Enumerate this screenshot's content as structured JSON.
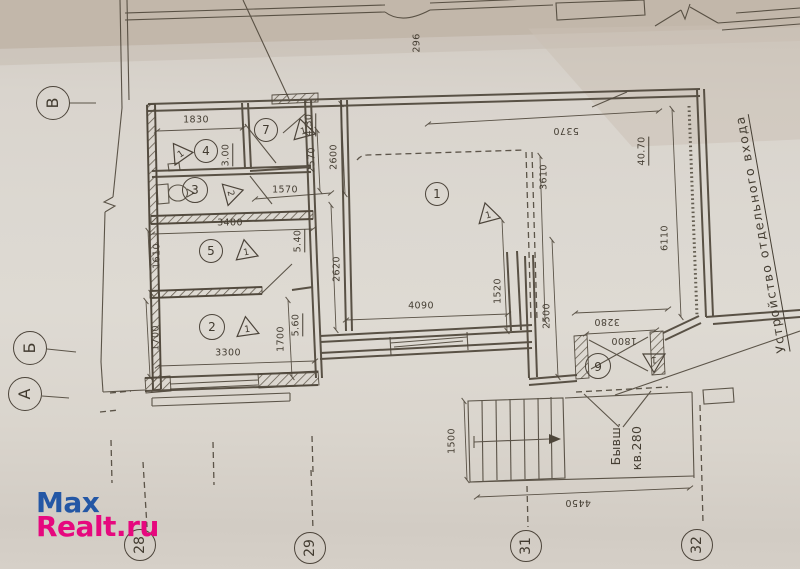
{
  "document_type": "floor-plan-photo",
  "ink_color": "#4e463a",
  "watermark": {
    "line1": "Max",
    "line2": "Realt.ru",
    "color1": "#2457a5",
    "color2": "#e6087e"
  },
  "axis_circles": [
    {
      "label": "В",
      "x": 53,
      "y": 103,
      "r": 17,
      "rot": -90
    },
    {
      "label": "Б",
      "x": 30,
      "y": 348,
      "r": 17,
      "rot": -90
    },
    {
      "label": "А",
      "x": 25,
      "y": 394,
      "r": 17,
      "rot": -90
    },
    {
      "label": "28",
      "x": 140,
      "y": 545,
      "r": 16,
      "rot": -90
    },
    {
      "label": "29",
      "x": 310,
      "y": 548,
      "r": 16,
      "rot": -90
    },
    {
      "label": "31",
      "x": 526,
      "y": 546,
      "r": 16,
      "rot": -90
    },
    {
      "label": "32",
      "x": 697,
      "y": 545,
      "r": 16,
      "rot": -90
    }
  ],
  "room_circles": [
    {
      "label": "1",
      "x": 437,
      "y": 194,
      "r": 12,
      "rot": 0
    },
    {
      "label": "2",
      "x": 212,
      "y": 327,
      "r": 13,
      "rot": 0
    },
    {
      "label": "3",
      "x": 195,
      "y": 190,
      "r": 13,
      "rot": 0
    },
    {
      "label": "4",
      "x": 206,
      "y": 151,
      "r": 12,
      "rot": 0
    },
    {
      "label": "5",
      "x": 211,
      "y": 251,
      "r": 12,
      "rot": 0
    },
    {
      "label": "6",
      "x": 598,
      "y": 366,
      "r": 13,
      "rot": 180
    },
    {
      "label": "7",
      "x": 266,
      "y": 130,
      "r": 12,
      "rot": 0
    }
  ],
  "triangle_markers": [
    {
      "label": "1",
      "x": 180,
      "y": 153,
      "rot": -35
    },
    {
      "label": "1",
      "x": 303,
      "y": 130,
      "rot": -15
    },
    {
      "label": "2",
      "x": 232,
      "y": 193,
      "rot": 75
    },
    {
      "label": "1",
      "x": 246,
      "y": 251,
      "rot": -10
    },
    {
      "label": "1",
      "x": 247,
      "y": 328,
      "rot": -8
    },
    {
      "label": "1",
      "x": 488,
      "y": 214,
      "rot": -15
    },
    {
      "label": "1",
      "x": 654,
      "y": 361,
      "rot": 180
    }
  ],
  "dimensions": [
    {
      "text": "1830",
      "x": 196,
      "y": 120,
      "rot": 0,
      "u": false
    },
    {
      "text": "2570",
      "x": 312,
      "y": 160,
      "rot": -90,
      "u": false
    },
    {
      "text": "2600",
      "x": 334,
      "y": 157,
      "rot": -90,
      "u": false
    },
    {
      "text": "3.00",
      "x": 227,
      "y": 155,
      "rot": -90,
      "u": true
    },
    {
      "text": "4.30",
      "x": 310,
      "y": 125,
      "rot": -90,
      "u": true
    },
    {
      "text": "1570",
      "x": 285,
      "y": 190,
      "rot": 0,
      "u": false
    },
    {
      "text": "3400",
      "x": 230,
      "y": 223,
      "rot": 0,
      "u": false
    },
    {
      "text": "1610",
      "x": 157,
      "y": 256,
      "rot": -90,
      "u": false
    },
    {
      "text": "5.40",
      "x": 299,
      "y": 241,
      "rot": -90,
      "u": true
    },
    {
      "text": "5.60",
      "x": 297,
      "y": 325,
      "rot": -90,
      "u": true
    },
    {
      "text": "1700",
      "x": 156,
      "y": 338,
      "rot": -90,
      "u": false
    },
    {
      "text": "3300",
      "x": 228,
      "y": 353,
      "rot": 0,
      "u": false
    },
    {
      "text": "1700",
      "x": 281,
      "y": 339,
      "rot": -90,
      "u": false
    },
    {
      "text": "2620",
      "x": 337,
      "y": 269,
      "rot": -90,
      "u": false
    },
    {
      "text": "4090",
      "x": 421,
      "y": 306,
      "rot": 0,
      "u": false
    },
    {
      "text": "1520",
      "x": 498,
      "y": 291,
      "rot": -90,
      "u": false
    },
    {
      "text": "2500",
      "x": 547,
      "y": 316,
      "rot": -90,
      "u": false
    },
    {
      "text": "3280",
      "x": 607,
      "y": 321,
      "rot": 180,
      "u": false
    },
    {
      "text": "1800",
      "x": 624,
      "y": 340,
      "rot": 180,
      "u": false
    },
    {
      "text": "5370",
      "x": 566,
      "y": 130,
      "rot": 180,
      "u": false
    },
    {
      "text": "3610",
      "x": 544,
      "y": 177,
      "rot": -90,
      "u": false
    },
    {
      "text": "6110",
      "x": 665,
      "y": 238,
      "rot": -90,
      "u": false
    },
    {
      "text": "40.70",
      "x": 643,
      "y": 151,
      "rot": -90,
      "u": true
    },
    {
      "text": "1500",
      "x": 452,
      "y": 441,
      "rot": -90,
      "u": false
    },
    {
      "text": "4450",
      "x": 578,
      "y": 502,
      "rot": 180,
      "u": false
    },
    {
      "text": "296",
      "x": 417,
      "y": 43,
      "rot": -90,
      "u": false
    }
  ],
  "annotations": [
    {
      "text": "Устройство отдельного входа",
      "x": 762,
      "y": 234,
      "rot": -100,
      "cls": "big-note u"
    },
    {
      "text": "Бывш.",
      "x": 616,
      "y": 444,
      "rot": -90,
      "cls": "note"
    },
    {
      "text": "кв.280",
      "x": 637,
      "y": 448,
      "rot": -90,
      "cls": "note"
    }
  ]
}
